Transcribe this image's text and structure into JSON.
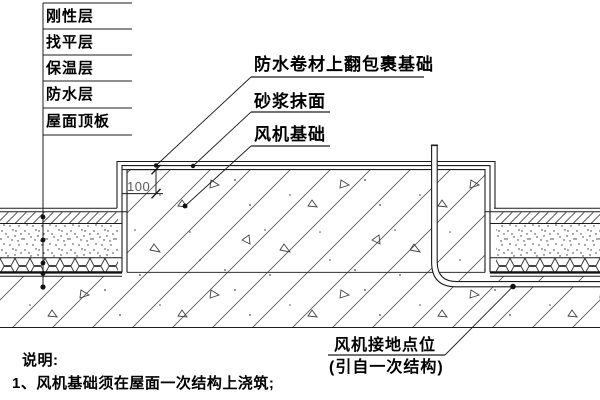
{
  "diagram": {
    "layer_callouts": [
      "刚性层",
      "找平层",
      "保温层",
      "防水层",
      "屋面顶板"
    ],
    "leader_labels": {
      "membrane_wrap": "防水卷材上翻包裹基础",
      "mortar_finish": "砂浆抹面",
      "fan_foundation": "风机基础"
    },
    "dimension": {
      "upstand_height": "100"
    },
    "grounding_callout": {
      "line1": "风机接地点位",
      "line2": "(引自一次结构)"
    },
    "notes": {
      "heading": "说明:",
      "item_1": "1、风机基础须在屋面一次结构上浇筑;"
    },
    "colors": {
      "ink": "#1c1c1c",
      "paper": "#ffffff"
    }
  }
}
